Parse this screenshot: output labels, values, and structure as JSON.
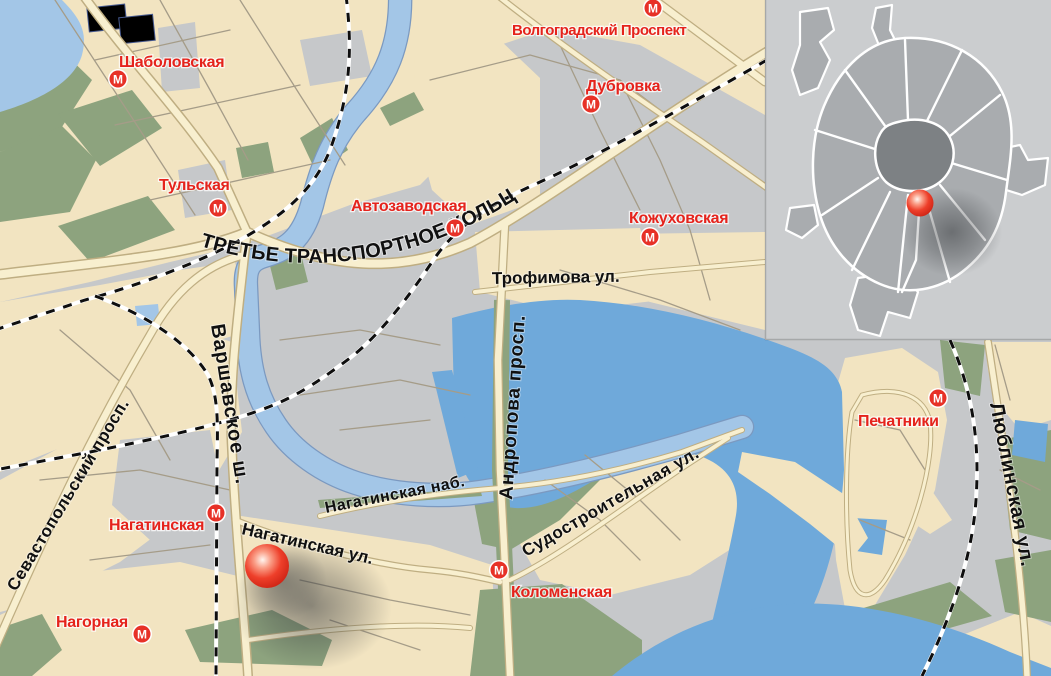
{
  "map": {
    "stations": [
      {
        "name": "Шаболовская"
      },
      {
        "name": "Тульская"
      },
      {
        "name": "Автозаводская"
      },
      {
        "name": "Волгоградский Проспект"
      },
      {
        "name": "Дубровка"
      },
      {
        "name": "Кожуховская"
      },
      {
        "name": "Печатники"
      },
      {
        "name": "Нагатинская"
      },
      {
        "name": "Нагорная"
      },
      {
        "name": "Коломенская"
      }
    ],
    "metro_icon_letter": "М",
    "streets": [
      {
        "name": "ТРЕТЬЕ ТРАНСПОРТНОЕ КОЛЬЦО"
      },
      {
        "name": "Трофимова ул."
      },
      {
        "name": "Севастопольский просп."
      },
      {
        "name": "Варшавское ш."
      },
      {
        "name": "Нагатинская наб."
      },
      {
        "name": "Андропова просп."
      },
      {
        "name": "Нагатинская ул."
      },
      {
        "name": "Судостроительная ул."
      },
      {
        "name": "Люблинская ул."
      }
    ],
    "marker": {
      "type": "location-ball"
    }
  },
  "inset": {
    "type": "moscow-overview-minimap",
    "marker": "location-ball"
  },
  "palette": {
    "land-beige": "#f2e4c1",
    "land-gray": "#c6c8ca",
    "land-pale": "#f7eed3",
    "green": "#8da37e",
    "water-light": "#a3c6e7",
    "water-bright": "#6fa9da",
    "road-case": "#bfae82",
    "road-fill": "#f8efcf",
    "road-minor": "#a59c88",
    "label-red": "#e5231c",
    "metro-red": "#e73127",
    "inset-bg": "#cbcdcf",
    "inset-mid": "#a9acaf",
    "inset-core": "#7d8184"
  }
}
